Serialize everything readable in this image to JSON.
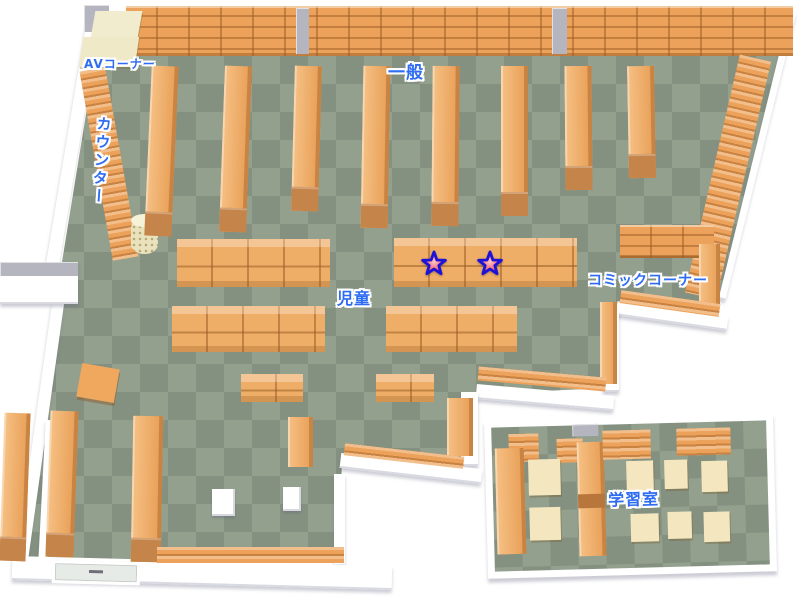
{
  "map": {
    "type": "library-floor-map",
    "areas": [
      {
        "id": "av-corner",
        "label": "AVコーナー"
      },
      {
        "id": "general",
        "label": "一般"
      },
      {
        "id": "counter",
        "label": "カウンター"
      },
      {
        "id": "children",
        "label": "児童"
      },
      {
        "id": "comic-corner",
        "label": "コミックコーナー"
      },
      {
        "id": "study-room",
        "label": "学習室"
      }
    ],
    "markers": [
      {
        "icon": "star",
        "x": 434,
        "y": 264
      },
      {
        "icon": "star",
        "x": 490,
        "y": 264
      }
    ],
    "colors": {
      "floor_light": "#93a08e",
      "floor_dark": "#849180",
      "shelf_orange": "#eca25a",
      "shelf_dark": "#c5854a",
      "table_cream": "#f4e7bf",
      "wall_white": "#ffffff",
      "label_blue": "#2e6cf2",
      "star_fill": "#ef4b60",
      "star_outline": "#1c12d8"
    }
  }
}
